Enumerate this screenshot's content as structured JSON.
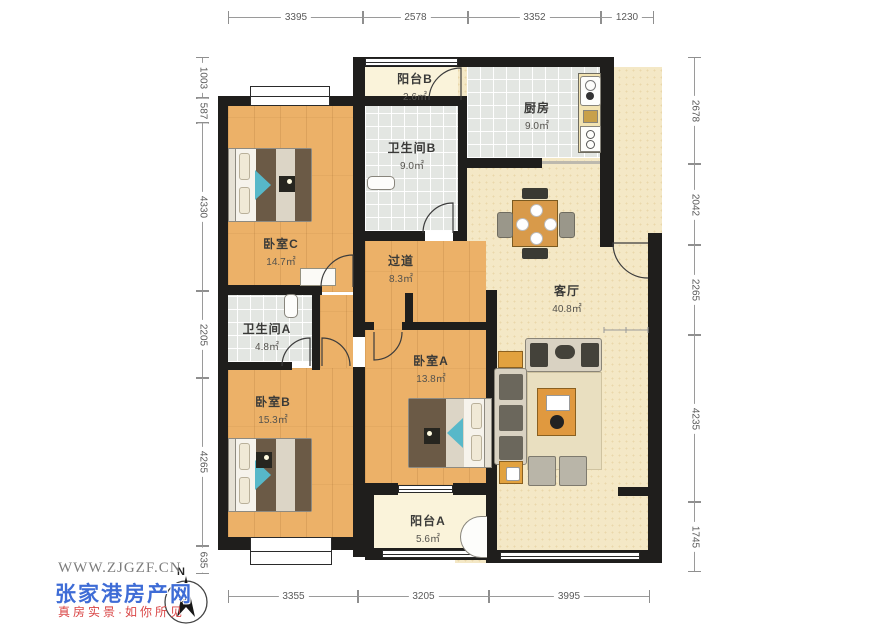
{
  "watermark": {
    "site": "WWW.ZJGZF.CN",
    "brand": "张家港房产网",
    "slogan": "真房实景·如你所见"
  },
  "compass": {
    "north_label": "N"
  },
  "rooms": [
    {
      "id": "balcony-b",
      "name": "阳台B",
      "area": "2.6㎡"
    },
    {
      "id": "kitchen",
      "name": "厨房",
      "area": "9.0㎡"
    },
    {
      "id": "bath-b",
      "name": "卫生间B",
      "area": "9.0㎡"
    },
    {
      "id": "bed-c",
      "name": "卧室C",
      "area": "14.7㎡"
    },
    {
      "id": "hallway",
      "name": "过道",
      "area": "8.3㎡"
    },
    {
      "id": "living",
      "name": "客厅",
      "area": "40.8㎡"
    },
    {
      "id": "bath-a",
      "name": "卫生间A",
      "area": "4.8㎡"
    },
    {
      "id": "bed-b",
      "name": "卧室B",
      "area": "15.3㎡"
    },
    {
      "id": "bed-a",
      "name": "卧室A",
      "area": "13.8㎡"
    },
    {
      "id": "balcony-a",
      "name": "阳台A",
      "area": "5.6㎡"
    }
  ],
  "dims": {
    "top": [
      "3395",
      "2578",
      "3352",
      "1230"
    ],
    "left": [
      "1003",
      "587",
      "4330",
      "2205",
      "4265",
      "635"
    ],
    "right": [
      "2678",
      "2042",
      "2265",
      "4235",
      "1745"
    ],
    "bottom": [
      "3355",
      "3205",
      "3995"
    ]
  },
  "colors": {
    "wall": "#1f1e1c",
    "wood_floor": "#ecb168",
    "tile_floor": "#e3e6e2",
    "living_floor": "#f4e8c6",
    "balcony_floor": "#faf3da",
    "accent_teal": "#57b8c9",
    "accent_orange": "#e0993f",
    "brand_blue": "#3e6cd6",
    "brand_red": "#d94545"
  }
}
